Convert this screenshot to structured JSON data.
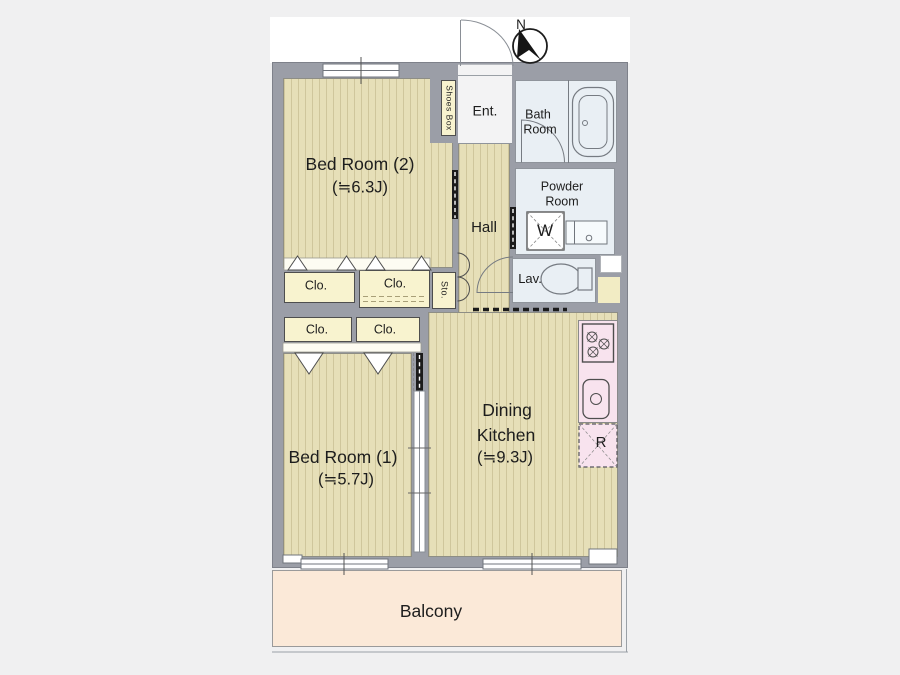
{
  "compass": {
    "north_label": "N"
  },
  "entrance": {
    "label": "Ent.",
    "shoes_box_label": "Shoes Box"
  },
  "rooms": {
    "bedroom2": {
      "name": "Bed Room (2)",
      "size": "(≒6.3J)"
    },
    "bedroom1": {
      "name": "Bed Room (1)",
      "size": "(≒5.7J)"
    },
    "dining_kitchen": {
      "name_line1": "Dining",
      "name_line2": "Kitchen",
      "size": "(≒9.3J)"
    },
    "hall": {
      "name": "Hall"
    },
    "bath_room": {
      "name_line1": "Bath",
      "name_line2": "Room"
    },
    "powder_room": {
      "name_line1": "Powder",
      "name_line2": "Room"
    },
    "lavatory": {
      "name": "Lav."
    },
    "balcony": {
      "name": "Balcony"
    }
  },
  "storage": {
    "closets": [
      {
        "label": "Clo."
      },
      {
        "label": "Clo."
      },
      {
        "label": "Clo."
      },
      {
        "label": "Clo."
      }
    ],
    "storage_label": "Sto."
  },
  "fixtures": {
    "washing_machine_label": "W",
    "refrigerator_label": "R"
  },
  "colors": {
    "background": "#f0f0f1",
    "wall": "#9b9ea7",
    "floor": "#e6dfb8",
    "floor_stripe": "#cfc69c",
    "closet": "#f8f3cf",
    "wet_area": "#e9eff4",
    "kitchen_counter": "#f8e3ee",
    "balcony": "#fbe9d8"
  }
}
